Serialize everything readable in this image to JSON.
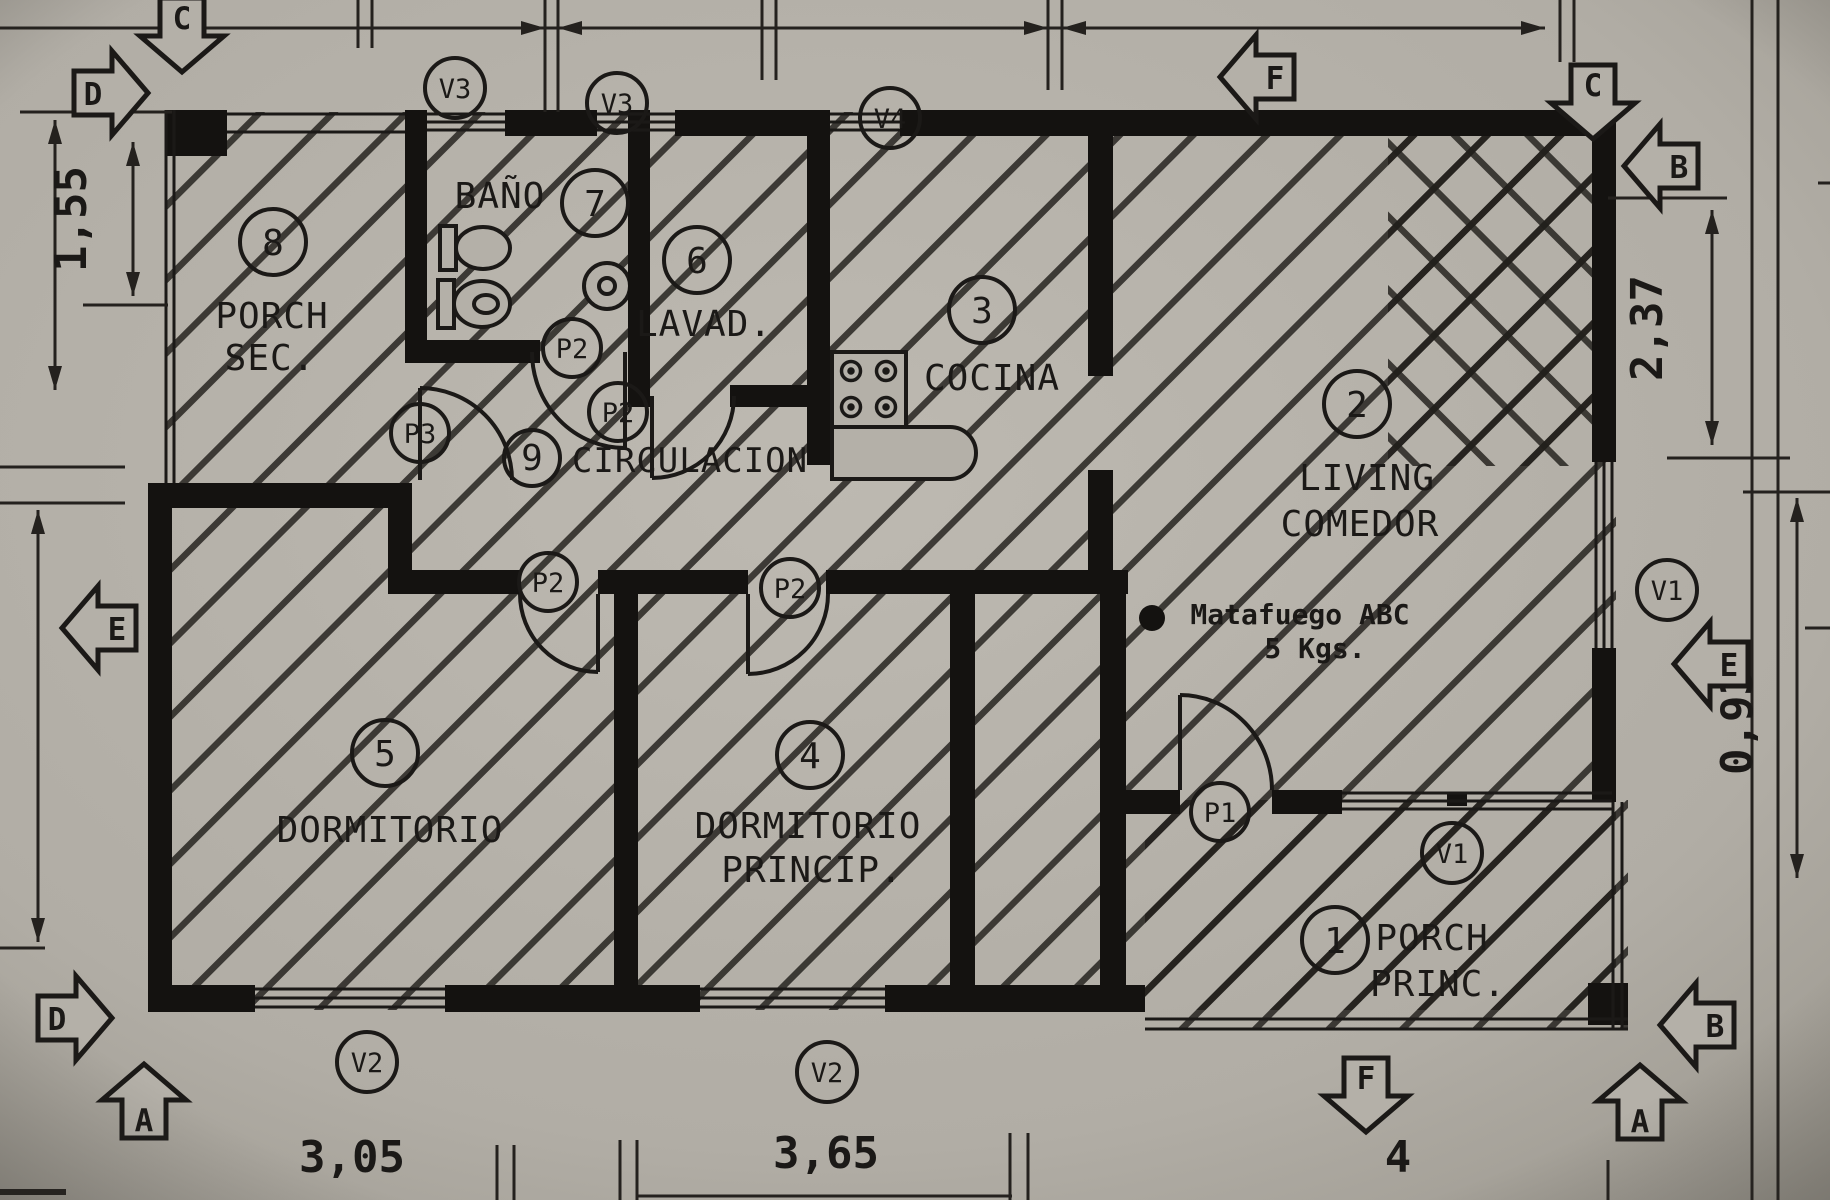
{
  "document": {
    "type": "architectural floor plan (scanned)"
  },
  "palette": {
    "paper": "#b4b0a8",
    "paper_light": "#bdb9b1",
    "paper_dark": "#9c988f",
    "ink": "#1b1917"
  },
  "rooms": [
    {
      "id": "porch-sec",
      "num": "8",
      "line1": "PORCH",
      "line2": "SEC."
    },
    {
      "id": "bano",
      "num": "7",
      "line1": "BAÑO",
      "line2": ""
    },
    {
      "id": "lavadero",
      "num": "6",
      "line1": "LAVAD.",
      "line2": ""
    },
    {
      "id": "cocina",
      "num": "3",
      "line1": "COCINA",
      "line2": ""
    },
    {
      "id": "living-comedor",
      "num": "2",
      "line1": "LIVING",
      "line2": "COMEDOR"
    },
    {
      "id": "circulacion",
      "num": "9",
      "line1": "CIRCULACION",
      "line2": ""
    },
    {
      "id": "dormitorio",
      "num": "5",
      "line1": "DORMITORIO",
      "line2": ""
    },
    {
      "id": "dormitorio-principal",
      "num": "4",
      "line1": "DORMITORIO",
      "line2": "PRINCIP."
    },
    {
      "id": "porch-principal",
      "num": "1",
      "line1": "PORCH",
      "line2": "PRINC."
    }
  ],
  "windows": [
    {
      "label": "V3"
    },
    {
      "label": "V3"
    },
    {
      "label": "V4"
    },
    {
      "label": "V1"
    },
    {
      "label": "V1"
    },
    {
      "label": "V2"
    },
    {
      "label": "V2"
    }
  ],
  "doors": [
    {
      "label": "P3"
    },
    {
      "label": "P2"
    },
    {
      "label": "P2"
    },
    {
      "label": "P2"
    },
    {
      "label": "P2"
    },
    {
      "label": "P1"
    }
  ],
  "dimensions": [
    {
      "value": "1,55"
    },
    {
      "value": "2,37"
    },
    {
      "value": "0,93"
    },
    {
      "value": "3,05"
    },
    {
      "value": "3,65"
    },
    {
      "value": "4"
    }
  ],
  "section_markers": [
    {
      "letter": "C"
    },
    {
      "letter": "D"
    },
    {
      "letter": "F"
    },
    {
      "letter": "C"
    },
    {
      "letter": "B"
    },
    {
      "letter": "E"
    },
    {
      "letter": "E"
    },
    {
      "letter": "D"
    },
    {
      "letter": "A"
    },
    {
      "letter": "F"
    },
    {
      "letter": "A"
    },
    {
      "letter": "B"
    }
  ],
  "annotations": {
    "extinguisher_line1": "Matafuego ABC",
    "extinguisher_line2": "5 Kgs."
  }
}
